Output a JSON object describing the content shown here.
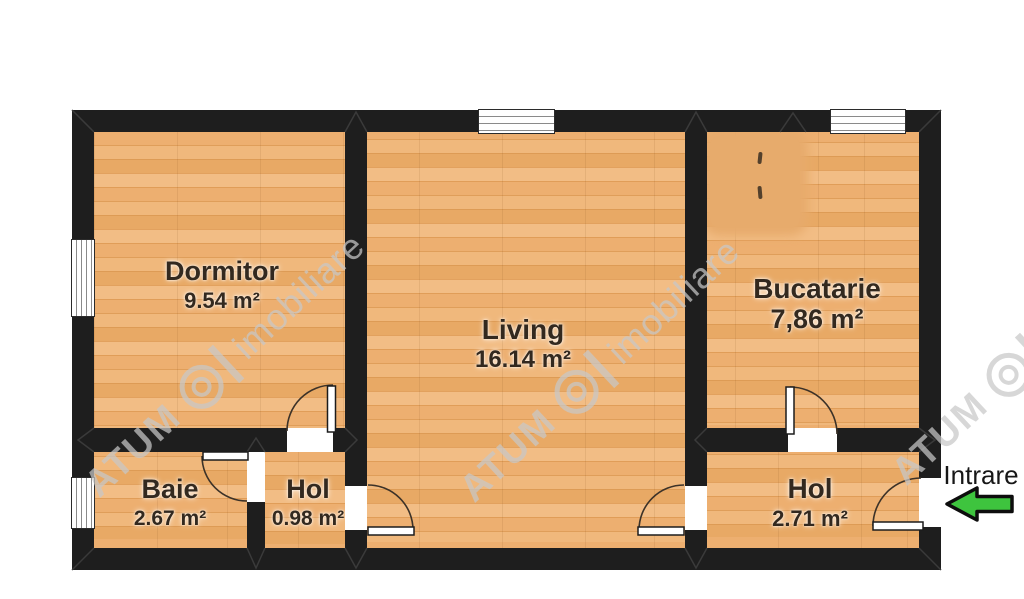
{
  "floorplan": {
    "rooms": [
      {
        "name": "Dormitor",
        "area": "9.54 m²"
      },
      {
        "name": "Living",
        "area": "16.14 m²"
      },
      {
        "name": "Bucatarie",
        "area": "7,86 m²"
      },
      {
        "name": "Baie",
        "area": "2.67 m²"
      },
      {
        "name": "Hol",
        "area": "0.98 m²"
      },
      {
        "name": "Hol",
        "area": "2.71 m²"
      }
    ],
    "entrance": {
      "label": "Intrare"
    },
    "watermark": {
      "brand": "ATUM",
      "suffix": "imobiliare"
    },
    "icons": {
      "entrance_arrow": "left-arrow"
    },
    "colors": {
      "wall": "#1e1e1e",
      "floor": "#e9aa68",
      "label": "#33291f",
      "arrow": "#3ec43e",
      "wm": "#c8c8c8"
    }
  }
}
